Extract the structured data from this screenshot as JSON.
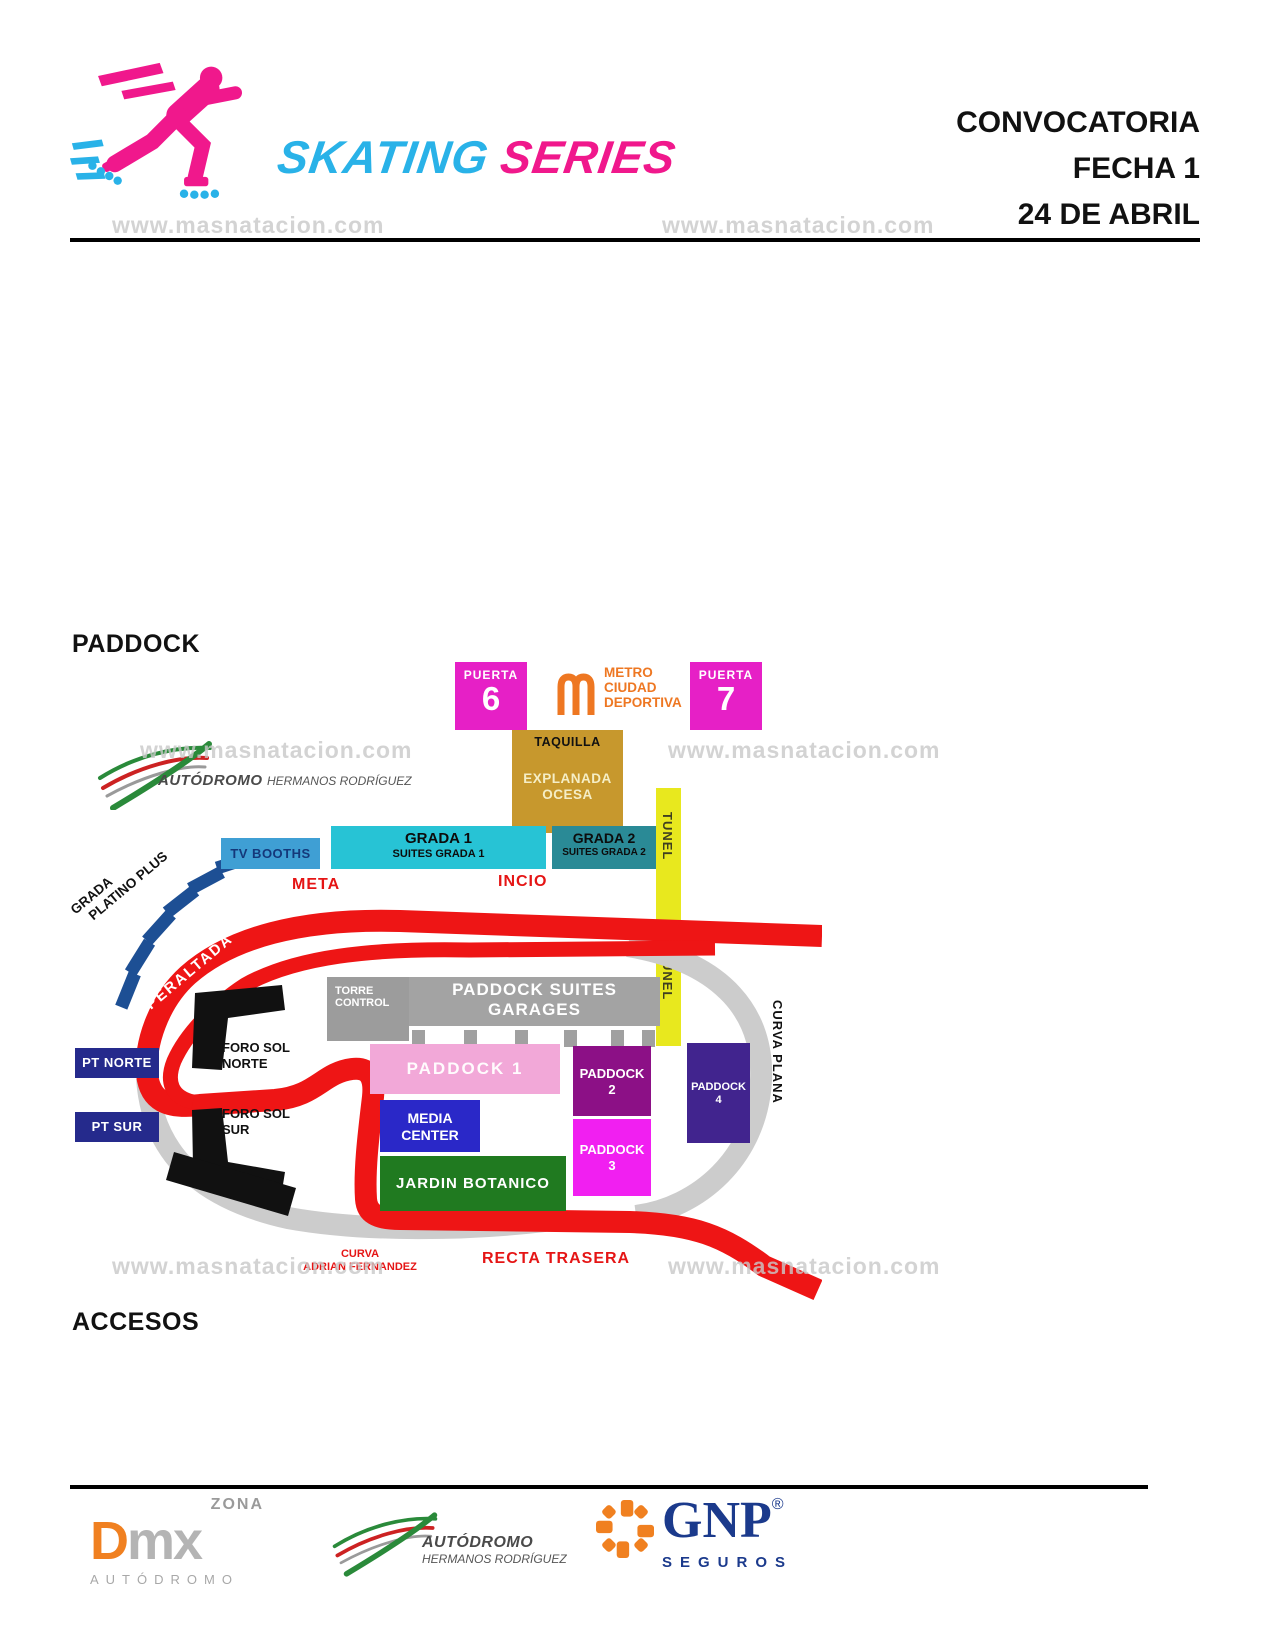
{
  "header": {
    "logo": {
      "word1": "SKATING",
      "word2": "SERIES"
    },
    "title_lines": [
      "CONVOCATORIA",
      "FECHA 1",
      "24 DE ABRIL"
    ]
  },
  "watermark": {
    "text": "www.masnatacion.com"
  },
  "sections": {
    "paddock": "PADDOCK",
    "accesos": "ACCESOS"
  },
  "map": {
    "venue_logo": {
      "name": "AUTÓDROMO",
      "tagline": "HERMANOS RODRÍGUEZ"
    },
    "puerta6": {
      "label": "PUERTA",
      "number": "6"
    },
    "puerta7": {
      "label": "PUERTA",
      "number": "7"
    },
    "metro": {
      "line1": "METRO",
      "line2": "CIUDAD",
      "line3": "DEPORTIVA"
    },
    "taquilla": {
      "title": "TAQUILLA",
      "line1": "EXPLANADA",
      "line2": "OCESA"
    },
    "tunel": {
      "label": "TUNEL"
    },
    "tv_booths": {
      "label": "TV BOOTHS"
    },
    "grada1": {
      "line1": "GRADA 1",
      "line2": "SUITES GRADA 1"
    },
    "grada2": {
      "line1": "GRADA 2",
      "line2": "SUITES GRADA 2"
    },
    "meta": {
      "label": "META"
    },
    "incio": {
      "label": "INCIO"
    },
    "grada_platino": {
      "line1": "GRADA",
      "line2": "PLATINO PLUS"
    },
    "peraltada": {
      "label": "PERALTADA"
    },
    "torre_control": {
      "line1": "TORRE",
      "line2": "CONTROL"
    },
    "garages": {
      "line1": "PADDOCK SUITES",
      "line2": "GARAGES"
    },
    "pt_norte": {
      "label": "PT NORTE"
    },
    "pt_sur": {
      "label": "PT SUR"
    },
    "foro_sol_norte": {
      "line1": "FORO SOL",
      "line2": "NORTE"
    },
    "foro_sol_sur": {
      "line1": "FORO SOL",
      "line2": "SUR"
    },
    "paddock1": {
      "label": "PADDOCK 1"
    },
    "paddock2": {
      "line1": "PADDOCK",
      "line2": "2"
    },
    "paddock3": {
      "line1": "PADDOCK",
      "line2": "3"
    },
    "paddock4": {
      "line1": "PADDOCK",
      "line2": "4"
    },
    "media_center": {
      "line1": "MEDIA",
      "line2": "CENTER"
    },
    "jardin": {
      "label": "JARDIN BOTANICO"
    },
    "curva_plana": {
      "label": "CURVA PLANA"
    },
    "curva_af": {
      "line1": "CURVA",
      "line2": "ADRIAN FERNANDEZ"
    },
    "recta_trasera": {
      "label": "RECTA TRASERA"
    }
  },
  "footer": {
    "dmx": {
      "zona": "ZONA",
      "d": "D",
      "mx": "mx",
      "sub": "AUTÓDROMO"
    },
    "autodromo": {
      "name": "AUTÓDROMO",
      "tagline": "HERMANOS RODRÍGUEZ"
    },
    "gnp": {
      "name": "GNP",
      "reg": "®",
      "sub": "SEGUROS"
    }
  },
  "colors": {
    "accent_pink": "#f0188c",
    "accent_cyan": "#29b2e8",
    "gate_magenta": "#e620c6",
    "metro_orange": "#ee7722",
    "taquilla_gold": "#c7982d",
    "tunnel_yellow": "#e8e81e",
    "track_red": "#ee1515",
    "track_gray": "#cccccc",
    "grada1_cyan": "#27c3d5",
    "grada2_teal": "#2a8a96",
    "tvbooths_blue": "#3f9fd4",
    "garage_gray": "#a3a3a3",
    "paddock1_pink": "#f2a8d8",
    "paddock2_purple": "#8c1086",
    "paddock3_magenta": "#f11ff1",
    "paddock4_indigo": "#41248e",
    "media_blue": "#2a28c8",
    "jardin_green": "#207a20",
    "pt_navy": "#252a8c",
    "gnp_navy": "#1b3a8c",
    "dmx_orange": "#f08020"
  }
}
